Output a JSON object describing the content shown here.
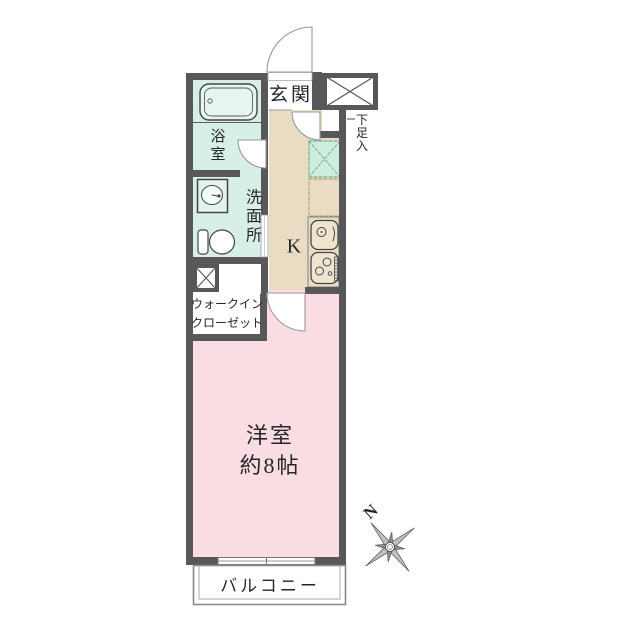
{
  "rooms": {
    "genkan": {
      "label": "玄関"
    },
    "bathroom": {
      "label": "浴室"
    },
    "washroom": {
      "label": "洗面所"
    },
    "walk_in_closet": {
      "label_lines": [
        "ウォークイン",
        "クローゼット"
      ]
    },
    "kitchen": {
      "label": "K"
    },
    "western_room": {
      "label": "洋室",
      "size": "約8帖"
    },
    "balcony": {
      "label": "バルコニー"
    },
    "shoe_cabinet": {
      "label": "下足入"
    }
  },
  "compass": {
    "north_label": "N"
  },
  "colors": {
    "wall": "#58585a",
    "wet_area_floor": "#d8efe5",
    "bathtub_fill": "#e6f5ee",
    "kitchen_floor": "#e9dcc2",
    "room_floor": "#fadde2",
    "refrigerator_space_fill": "#cdeedd",
    "refrigerator_space_border": "#6fb393",
    "text": "#26262c"
  }
}
